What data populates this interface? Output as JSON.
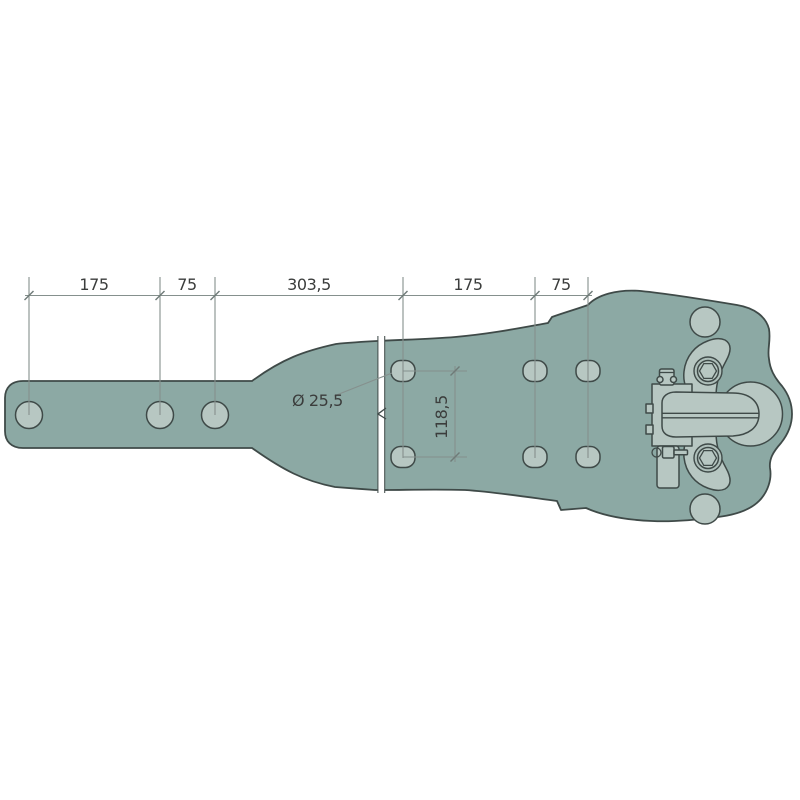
{
  "colors": {
    "body": "#8CA9A4",
    "light": "#B7C7C2",
    "outline": "#3F4A48",
    "dimension": "#85908D",
    "text": "#3B3D3C",
    "background": "#FFFFFF"
  },
  "dimensions": {
    "segments": {
      "s1": "175",
      "s2": "75",
      "s3": "303,5",
      "s4": "175",
      "s5": "75"
    },
    "vertical_spacing": "118,5",
    "hole_diameter": "Ø 25,5"
  }
}
